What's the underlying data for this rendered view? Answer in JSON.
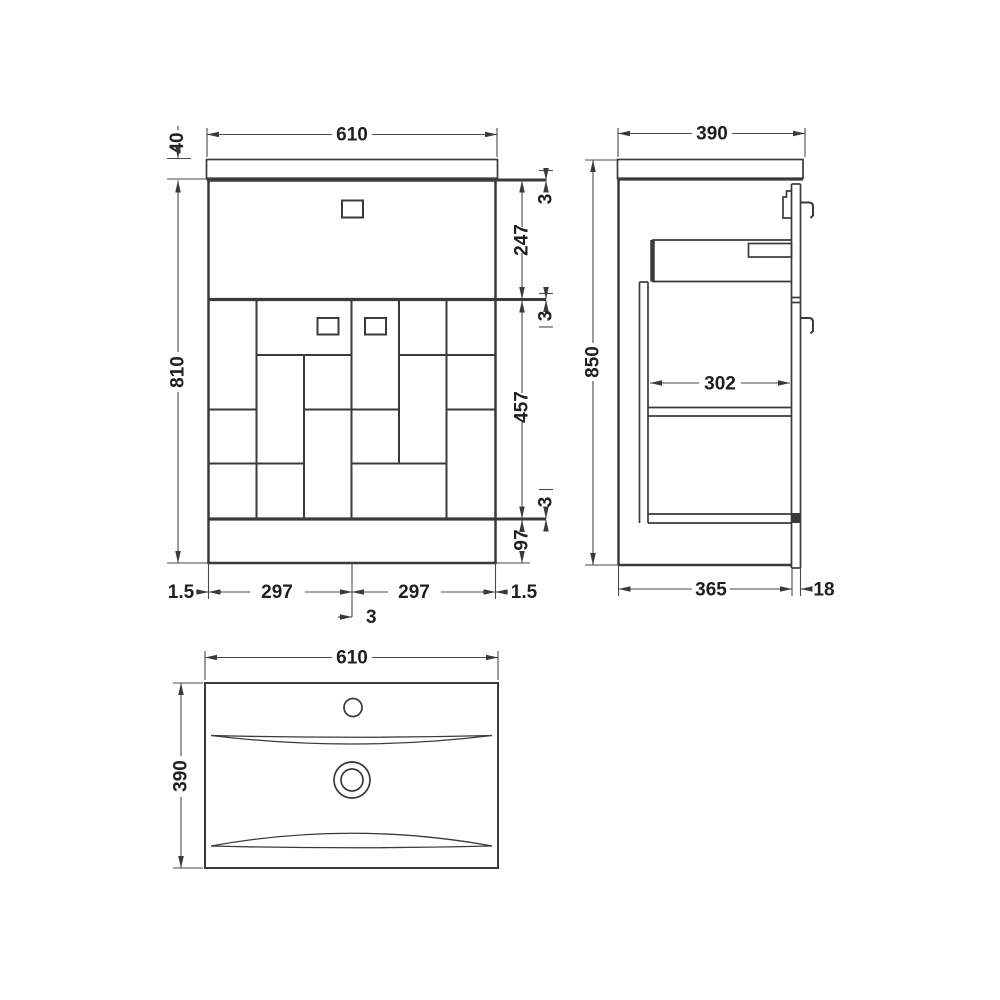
{
  "diagram": {
    "type": "technical-drawing",
    "subject": "vanity-unit-with-basin-dimensions",
    "units": "mm",
    "colors": {
      "line": "#3a3a3a",
      "text": "#1f1f1f",
      "background": "#ffffff"
    },
    "front_view": {
      "width": "610",
      "worktop_thickness": "40",
      "cabinet_height": "810",
      "gap_top": "3",
      "drawer_height": "247",
      "gap_middle": "3",
      "doors_height": "457",
      "gap_lower": "3",
      "plinth_height": "97",
      "edge_left": "1.5",
      "door_left_width": "297",
      "door_center_gap": "3",
      "door_right_width": "297",
      "edge_right": "1.5"
    },
    "side_view": {
      "depth": "390",
      "total_height": "850",
      "internal_depth": "302",
      "body_depth": "365",
      "door_thickness": "18"
    },
    "top_view": {
      "width": "610",
      "depth": "390"
    }
  }
}
